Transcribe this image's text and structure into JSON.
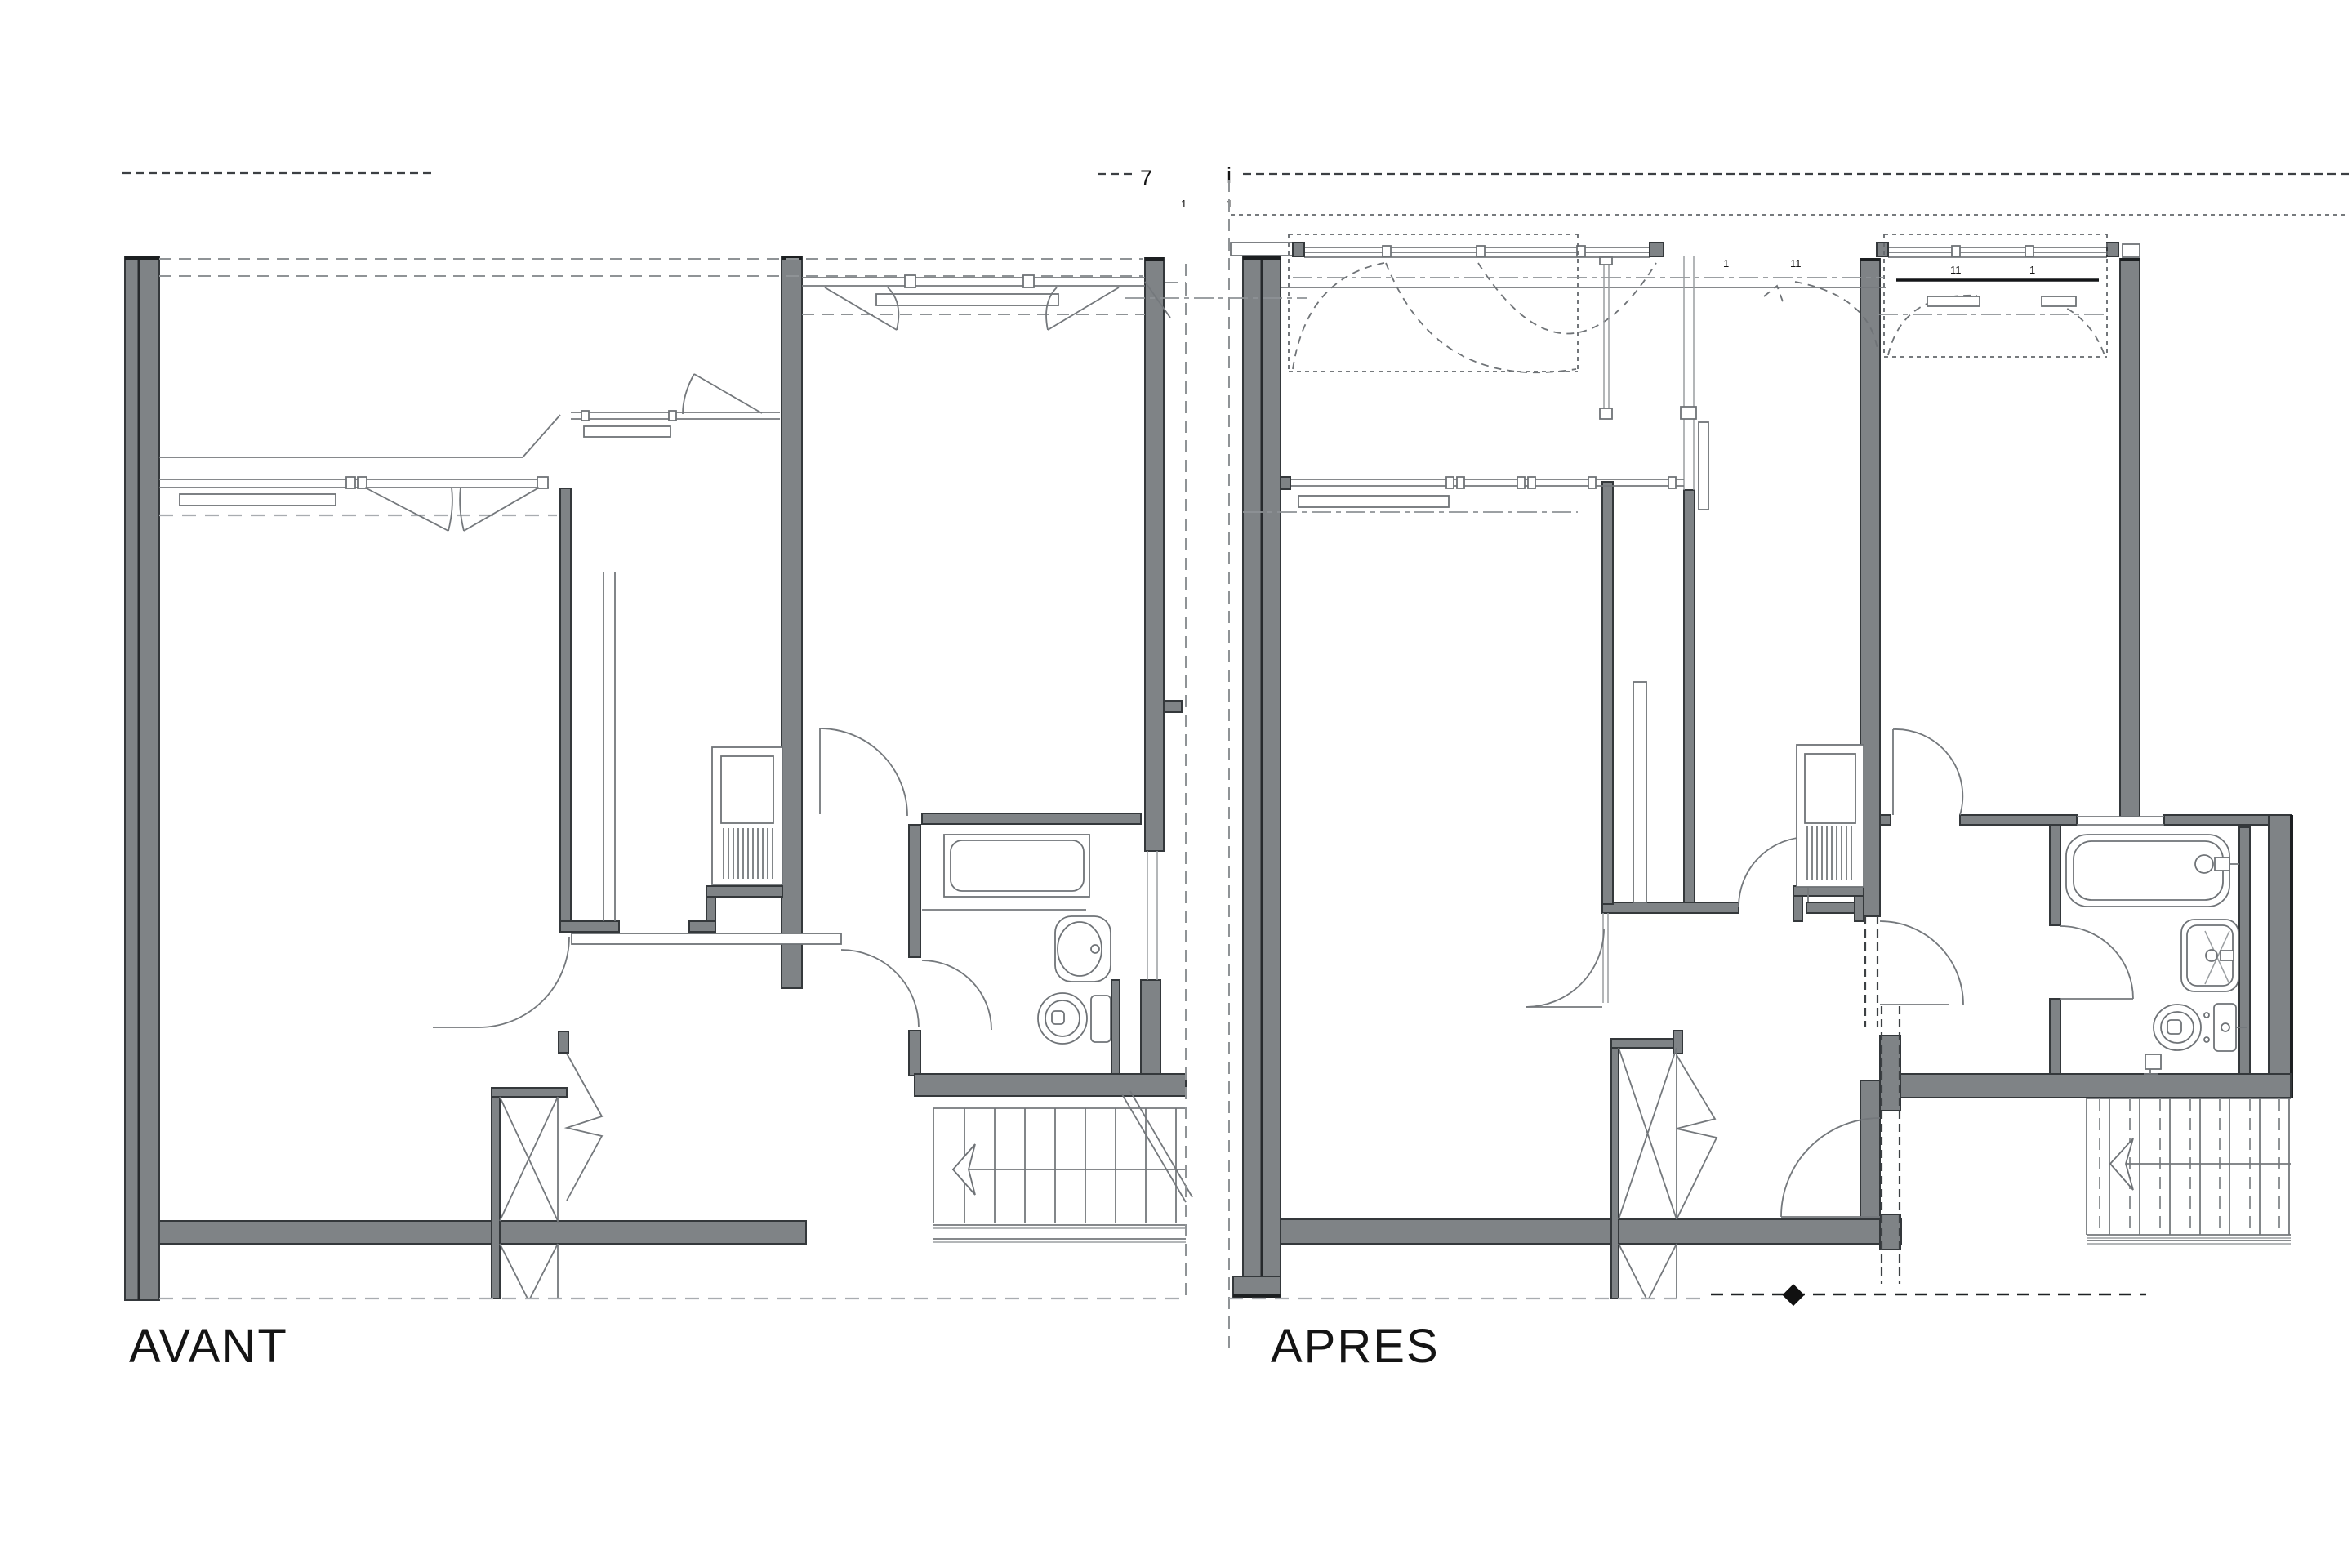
{
  "document": {
    "type": "architectural-floor-plan-comparison",
    "panels": [
      {
        "id": "avant",
        "label": "AVANT"
      },
      {
        "id": "apres",
        "label": "APRES"
      }
    ]
  },
  "labels": {
    "avant": "AVANT",
    "apres": "APRES"
  },
  "annotations": {
    "section_marker": "7",
    "axis_marker": "i",
    "ticks": [
      "1",
      "1",
      "1",
      "11",
      "11",
      "1"
    ]
  },
  "colors": {
    "background": "#ffffff",
    "wall_fill": "#7f8386",
    "wall_edge": "#34383b",
    "thin_line": "#74787c",
    "dash_dark": "#3c4043",
    "dash_light": "#a8acb0",
    "text": "#141414",
    "marker_diamond": "#111111"
  }
}
